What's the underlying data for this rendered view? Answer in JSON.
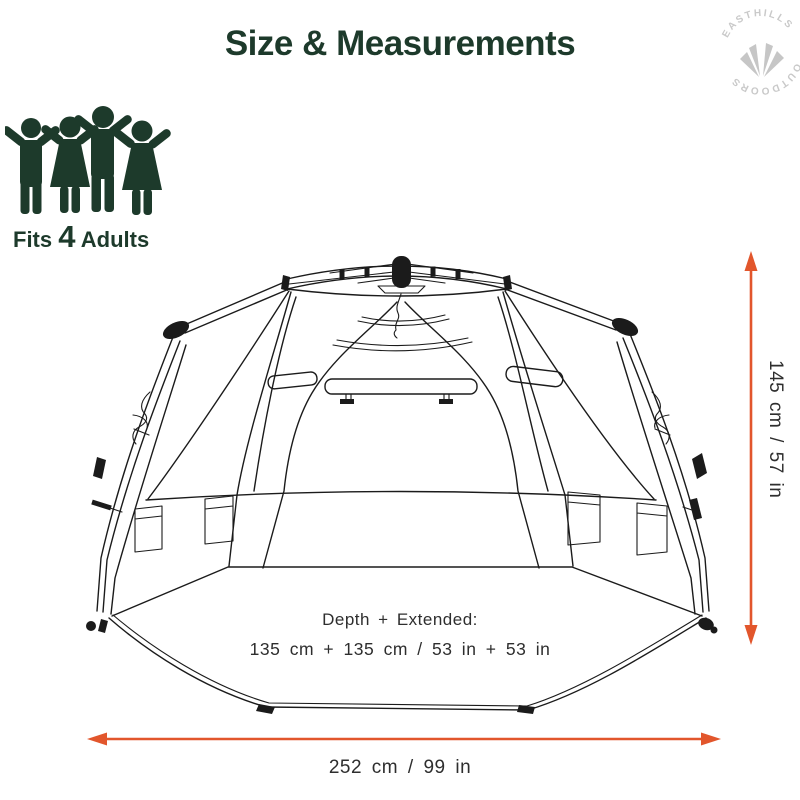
{
  "title": "Size & Measurements",
  "logo": {
    "top": "EASTHILLS",
    "bottom": "OUTDOORS"
  },
  "capacity": {
    "prefix": "Fits ",
    "number": "4",
    "suffix": " Adults"
  },
  "dimensions": {
    "height_label": "145 cm / 57 in",
    "width_label": "252 cm / 99 in",
    "depth_title": "Depth + Extended:",
    "depth_value": "135 cm + 135 cm / 53 in + 53 in"
  },
  "colors": {
    "brand_green": "#1d3a2b",
    "accent_orange": "#e2562c",
    "line_color": "#1b1b1b",
    "watermark_gray": "#c9c9c9"
  }
}
